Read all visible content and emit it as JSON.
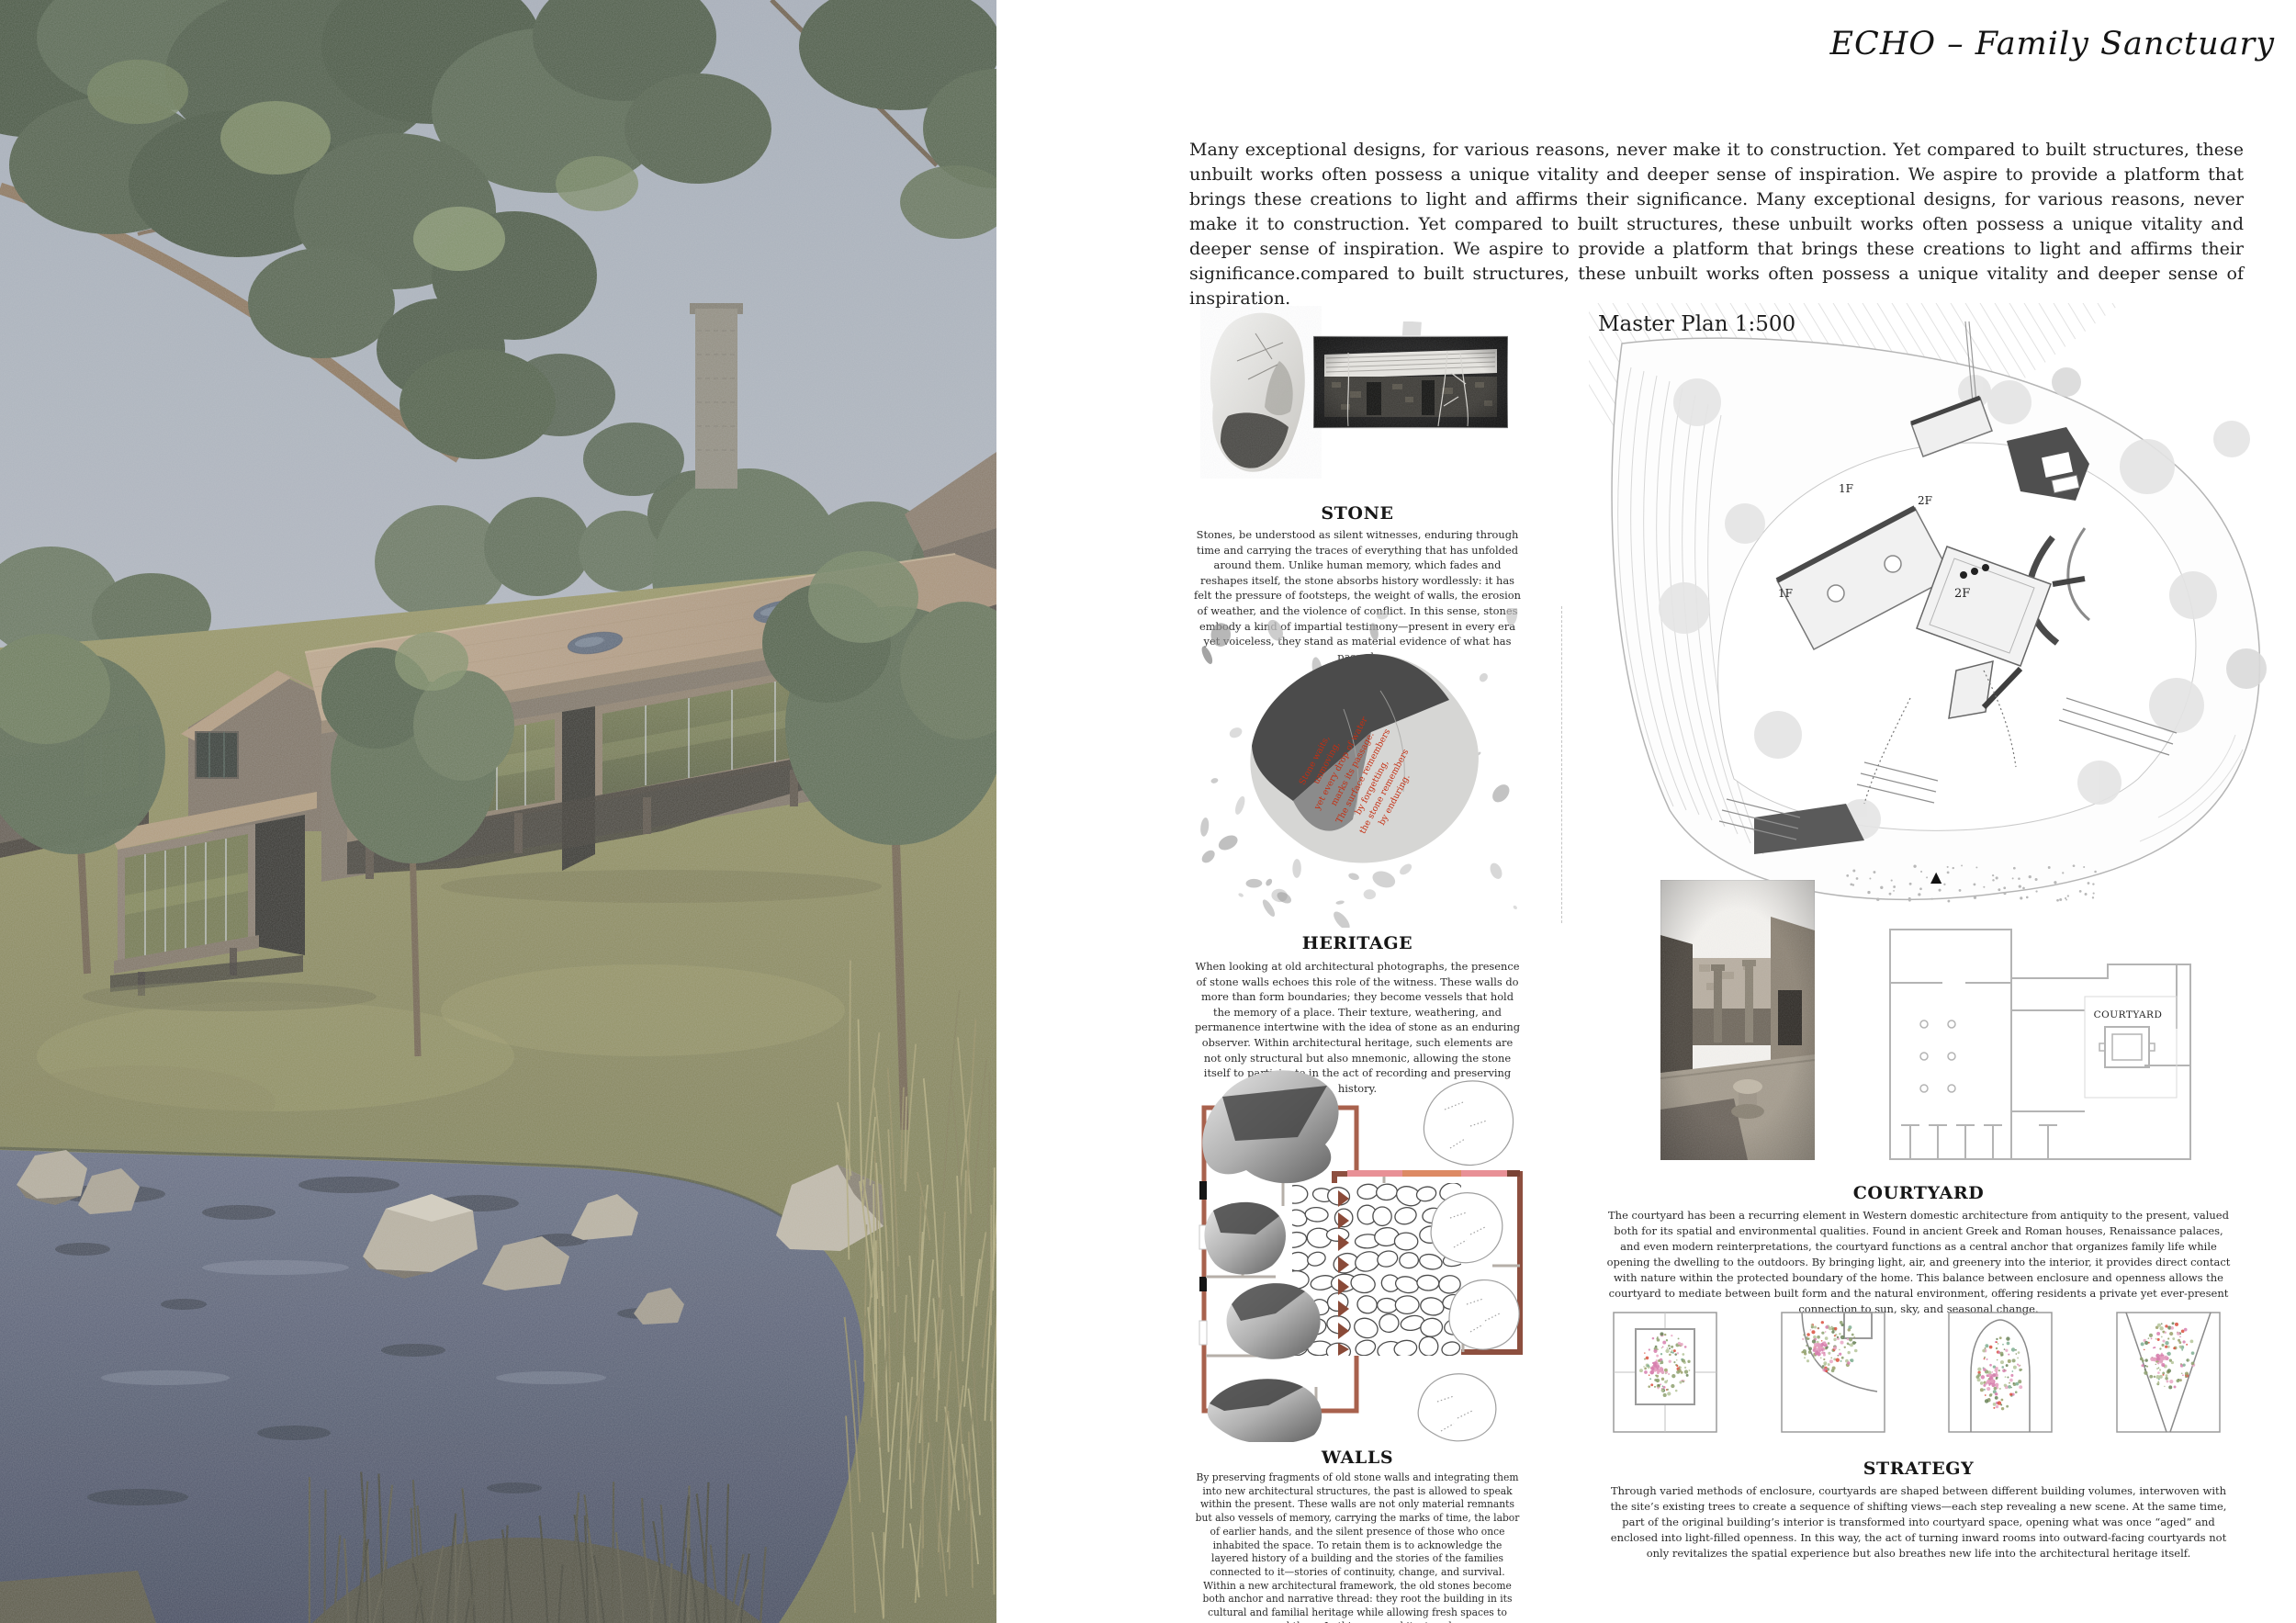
{
  "page": {
    "title": "ECHO – Family Sanctuary"
  },
  "intro": {
    "text": "Many exceptional designs, for various reasons, never make it to construction. Yet compared to built structures, these unbuilt works often possess a unique vitality and deeper sense of inspiration. We aspire to provide a platform that brings these creations to light and affirms their significance. Many exceptional designs, for various reasons, never make it to construction. Yet compared to built structures, these unbuilt works often possess a unique vitality and deeper sense of inspiration. We aspire to provide a platform that brings these creations to light and affirms their significance.compared to built structures, these unbuilt works often possess a unique vitality and deeper sense of inspiration."
  },
  "sections": {
    "stone": {
      "heading": "STONE",
      "body": "Stones, be understood as silent witnesses, enduring through time and carrying the traces of everything that has unfolded around them. Unlike human memory, which fades and reshapes itself, the stone absorbs history wordlessly: it has felt the pressure of footsteps, the weight of walls, the erosion of weather, and the violence of conflict. In this sense, stones embody a kind of impartial testimony—present in every era yet voiceless, they stand as material evidence of what has passed."
    },
    "heritage": {
      "heading": "HERITAGE",
      "body": "When looking at old architectural photographs, the presence of stone walls echoes this role of the witness. These walls do more than form boundaries; they become vessels that hold the memory of a place. Their texture, weathering, and permanence intertwine with the idea of stone as an enduring observer. Within architectural heritage, such elements are not only structural but also mnemonic, allowing the stone itself to participate in the act of recording and preserving history."
    },
    "walls": {
      "heading": "WALLS",
      "body": "By preserving fragments of old stone walls and integrating them into new architectural structures, the past is allowed to speak within the present. These walls are not only material remnants but also vessels of memory, carrying the marks of time, the labor of earlier hands, and the silent presence of those who once inhabited the space. To retain them is to acknowledge the layered history of a building and the stories of the families connected to it—stories of continuity, change, and survival. Within a new architectural framework, the old stones become both anchor and narrative thread: they root the building in its cultural and familial heritage while allowing fresh spaces to emerge around them. In this way, architecture becomes a dialogue between past and future, where the preserved wall stands as a witness and storyteller, ensuring that what was once lived is not erased but carried forward into what is yet to come."
    },
    "courtyard": {
      "heading": "COURTYARD",
      "body": "The courtyard has been a recurring element in Western domestic architecture from antiquity to the present, valued both for its spatial and environmental qualities. Found in ancient Greek and Roman houses, Renaissance palaces, and even modern reinterpretations, the courtyard functions as a central anchor that organizes family life while opening the dwelling to the outdoors. By bringing light, air, and greenery into the interior, it provides direct contact with nature within the protected boundary of the home. This balance between enclosure and openness allows the courtyard to mediate between built form and the natural environment, offering residents a private yet ever-present connection to sun, sky, and seasonal change."
    },
    "strategy": {
      "heading": "STRATEGY",
      "body": "Through varied methods of enclosure, courtyards are shaped between different building volumes, interwoven with the site’s existing trees to create a sequence of shifting views—each step revealing a new scene. At the same time, part of the original building’s interior is transformed into courtyard space, opening what was once “aged” and enclosed into light-filled openness. In this way, the act of turning inward rooms into outward-facing courtyards not only revitalizes the spatial experience but also breathes new life into the architectural heritage itself."
    }
  },
  "master_plan": {
    "title": "Master Plan 1:500",
    "floor_labels": [
      "1F",
      "2F",
      "2F",
      "1F"
    ],
    "north_arrow": "▲"
  },
  "roman_plan": {
    "courtyard_label": "COURTYARD"
  },
  "stone_annotation": {
    "lines": [
      "Stone waits,",
      "unmoving,",
      "yet every drop of water",
      "marks its passage.",
      "The surface remembers",
      "by forgetting,",
      "the stone remembers",
      "by enduring."
    ]
  },
  "colors": {
    "annotation_red": "#c52f12",
    "plan_brown": "#8d4f3f",
    "plan_pink": "#e89096",
    "plan_salmon": "#dd8a64"
  }
}
